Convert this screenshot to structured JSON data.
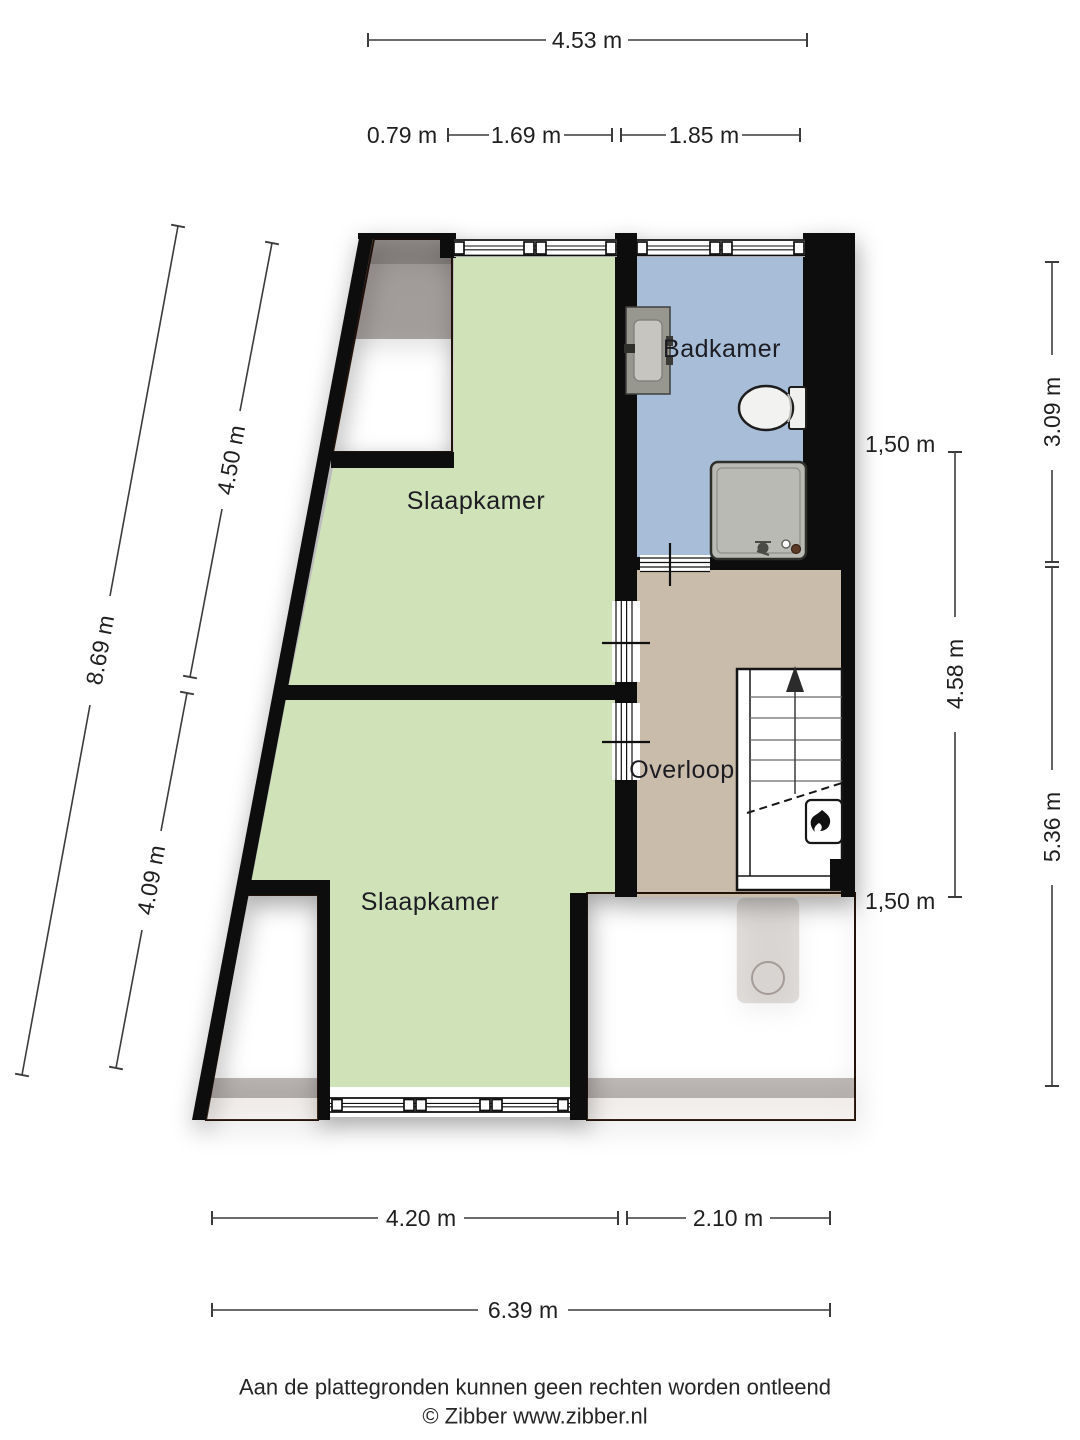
{
  "dimensions": {
    "top_total": "4.53 m",
    "top_seg_roof": "0.79 m",
    "top_seg_bedroom": "1.69 m",
    "top_seg_bathroom": "1.85 m",
    "left_total": "8.69 m",
    "left_upper": "4.50 m",
    "left_lower": "4.09 m",
    "right_bathroom": "3.09 m",
    "right_middle": "4.58 m",
    "right_lower": "5.36 m",
    "knee_height_top": "1,50 m",
    "knee_height_bottom": "1,50 m",
    "bottom_bedroom": "4.20 m",
    "bottom_landing": "2.10 m",
    "bottom_total": "6.39 m"
  },
  "rooms": {
    "bedroom_top": "Slaapkamer",
    "bathroom": "Badkamer",
    "landing": "Overloop",
    "bedroom_bottom": "Slaapkamer"
  },
  "footer": {
    "disclaimer": "Aan de plattegronden kunnen geen rechten worden ontleend",
    "credit": "© Zibber www.zibber.nl"
  },
  "colors": {
    "floor_bedroom": "#cfe2b8",
    "floor_bathroom": "#a7bdd8",
    "floor_landing": "#c9bcab",
    "roof_base": "#8f6850",
    "wall": "#0d0d0d",
    "dimension_line": "#3c3c3c"
  }
}
